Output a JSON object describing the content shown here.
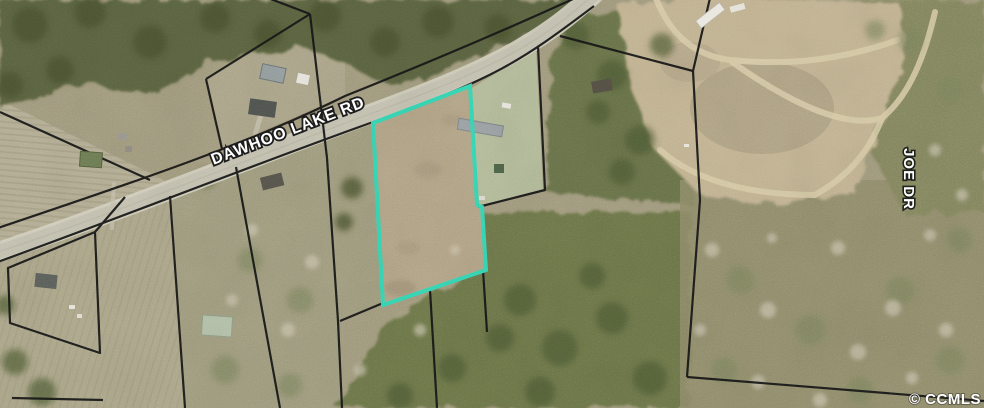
{
  "map": {
    "road_label": "DAWHOO LAKE RD",
    "side_road_label": "JOE DR",
    "watermark": "© CCMLS",
    "highlight_color": "#35d6b3",
    "parcel_line_color": "#171717",
    "label_color": "#ffffff",
    "road_color": "#c4c1b0"
  }
}
